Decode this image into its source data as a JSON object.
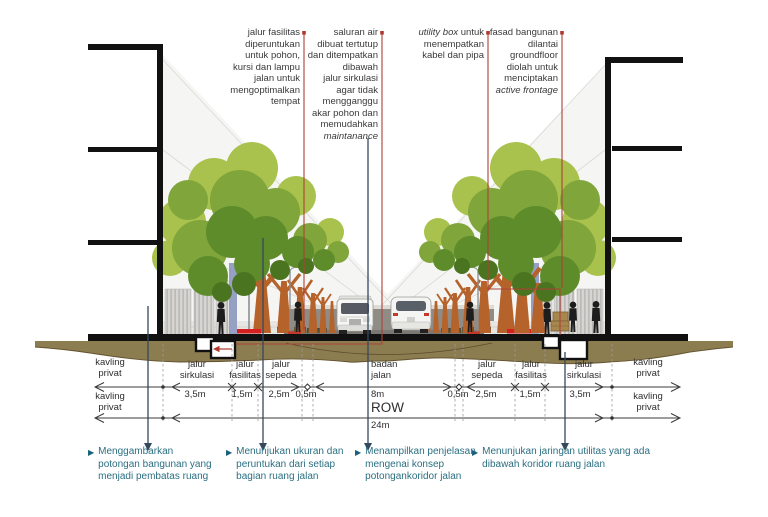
{
  "top_annotations": [
    {
      "segments": [
        {
          "t": "jalur fasilitas\ndiperuntukan\nuntuk pohon,\nkursi dan lampu\njalan untuk\nmengoptimalkan\ntempat",
          "i": false
        }
      ]
    },
    {
      "segments": [
        {
          "t": "saluran air\ndibuat tertutup\ndan ditempatkan\ndibawah\njalur sirkulasi\nagar tidak\nmengganggu\nakar pohon dan\nmemudahkan\n",
          "i": false
        },
        {
          "t": "maintanance",
          "i": true
        }
      ]
    },
    {
      "segments": [
        {
          "t": "utility box",
          "i": true
        },
        {
          "t": " untuk\nmenempatkan\nkabel dan pipa",
          "i": false
        }
      ]
    },
    {
      "segments": [
        {
          "t": "fasad bangunan\ndilantai\ngroundfloor\ndiolah untuk\nmenciptakan\n",
          "i": false
        },
        {
          "t": "active frontage",
          "i": true
        }
      ]
    }
  ],
  "dimensions": {
    "kavling_left_row1": "kavling\nprivat",
    "kavling_left_row2": "kavling\nprivat",
    "kavling_right_row1": "kavling\nprivat",
    "kavling_right_row2": "kavling\nprivat",
    "segments_left": [
      {
        "name": "jalur\nsirkulasi",
        "w": "3,5m"
      },
      {
        "name": "jalur\nfasilitas",
        "w": "1,5m"
      },
      {
        "name": "jalur\nsepeda",
        "w": "2,5m"
      },
      {
        "name": "",
        "w": "0,5m"
      }
    ],
    "center": {
      "name": "badan\njalan",
      "w": "8m",
      "row_label": "ROW",
      "row_w": "24m"
    },
    "segments_right": [
      {
        "name": "",
        "w": "0,5m"
      },
      {
        "name": "jalur\nsepeda",
        "w": "2,5m"
      },
      {
        "name": "jalur\nfasilitas",
        "w": "1,5m"
      },
      {
        "name": "jalur\nsirkulasi",
        "w": "3,5m"
      }
    ]
  },
  "bottom_annotations": [
    {
      "bullet": "▶",
      "text": "Menggambarkan\npotongan bangunan yang\nmenjadi pembatas ruang"
    },
    {
      "bullet": "▶",
      "text": "Menunjukan ukuran dan\nperuntukan dari setiap\nbagian ruang jalan"
    },
    {
      "bullet": "▶",
      "text": "Menampilkan penjelasan\nmengenai konsep\npotongankoridor jalan"
    },
    {
      "bullet": "▶",
      "text": "Menunjukan jaringan utilitas yang ada\ndibawah koridor ruang jalan"
    }
  ],
  "colors": {
    "leader_red": "#ae4136",
    "leader_navy": "#35495e",
    "annotation_teal": "#2b6f82",
    "soil_brown": "#8c7d51",
    "canopy_light": "#a9c14d",
    "canopy_mid": "#7fa53b",
    "canopy_dark": "#5f8c2b",
    "trunk_orange": "#b5622b",
    "road_gray": "#8f8b85",
    "accent_red": "#d42020",
    "ink": "#111111"
  }
}
